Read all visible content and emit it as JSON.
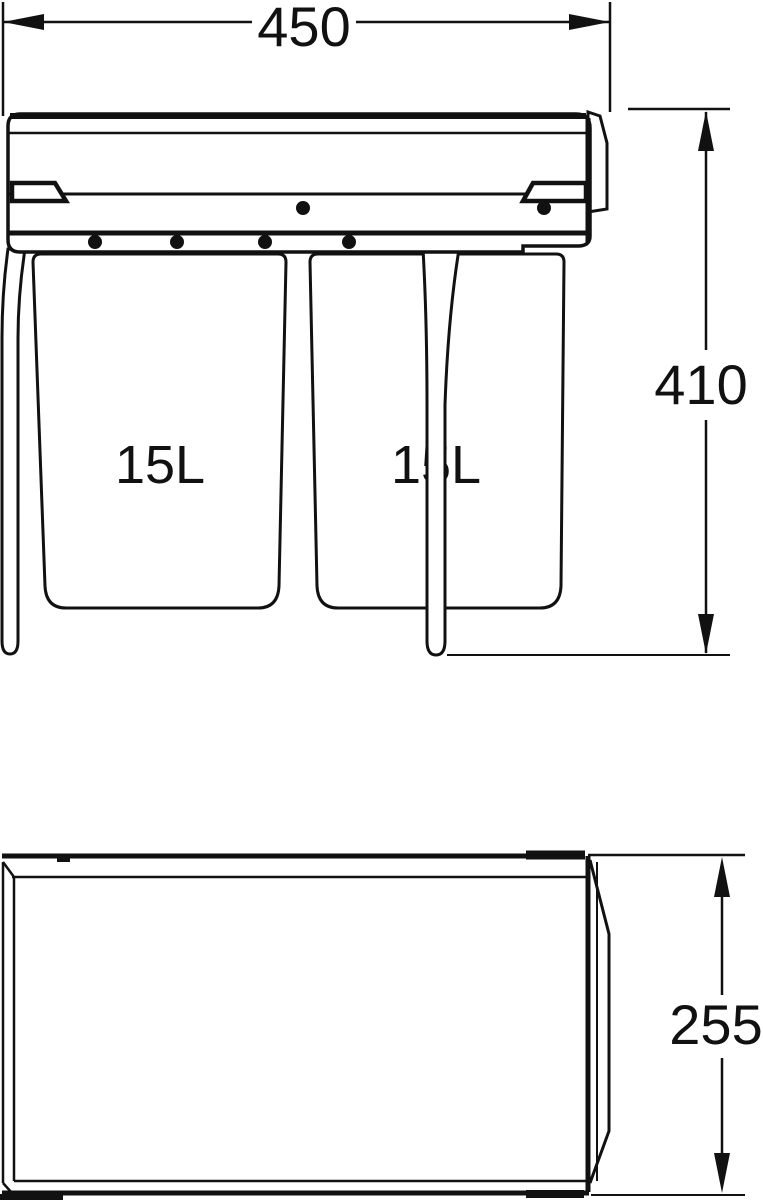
{
  "diagram": {
    "front_view": {
      "width_dim": "450",
      "height_dim": "410",
      "left_bin_label": "15L",
      "right_bin_label": "15L"
    },
    "side_view": {
      "depth_dim": "255"
    },
    "colors": {
      "line": "#111111",
      "background": "#ffffff"
    }
  }
}
